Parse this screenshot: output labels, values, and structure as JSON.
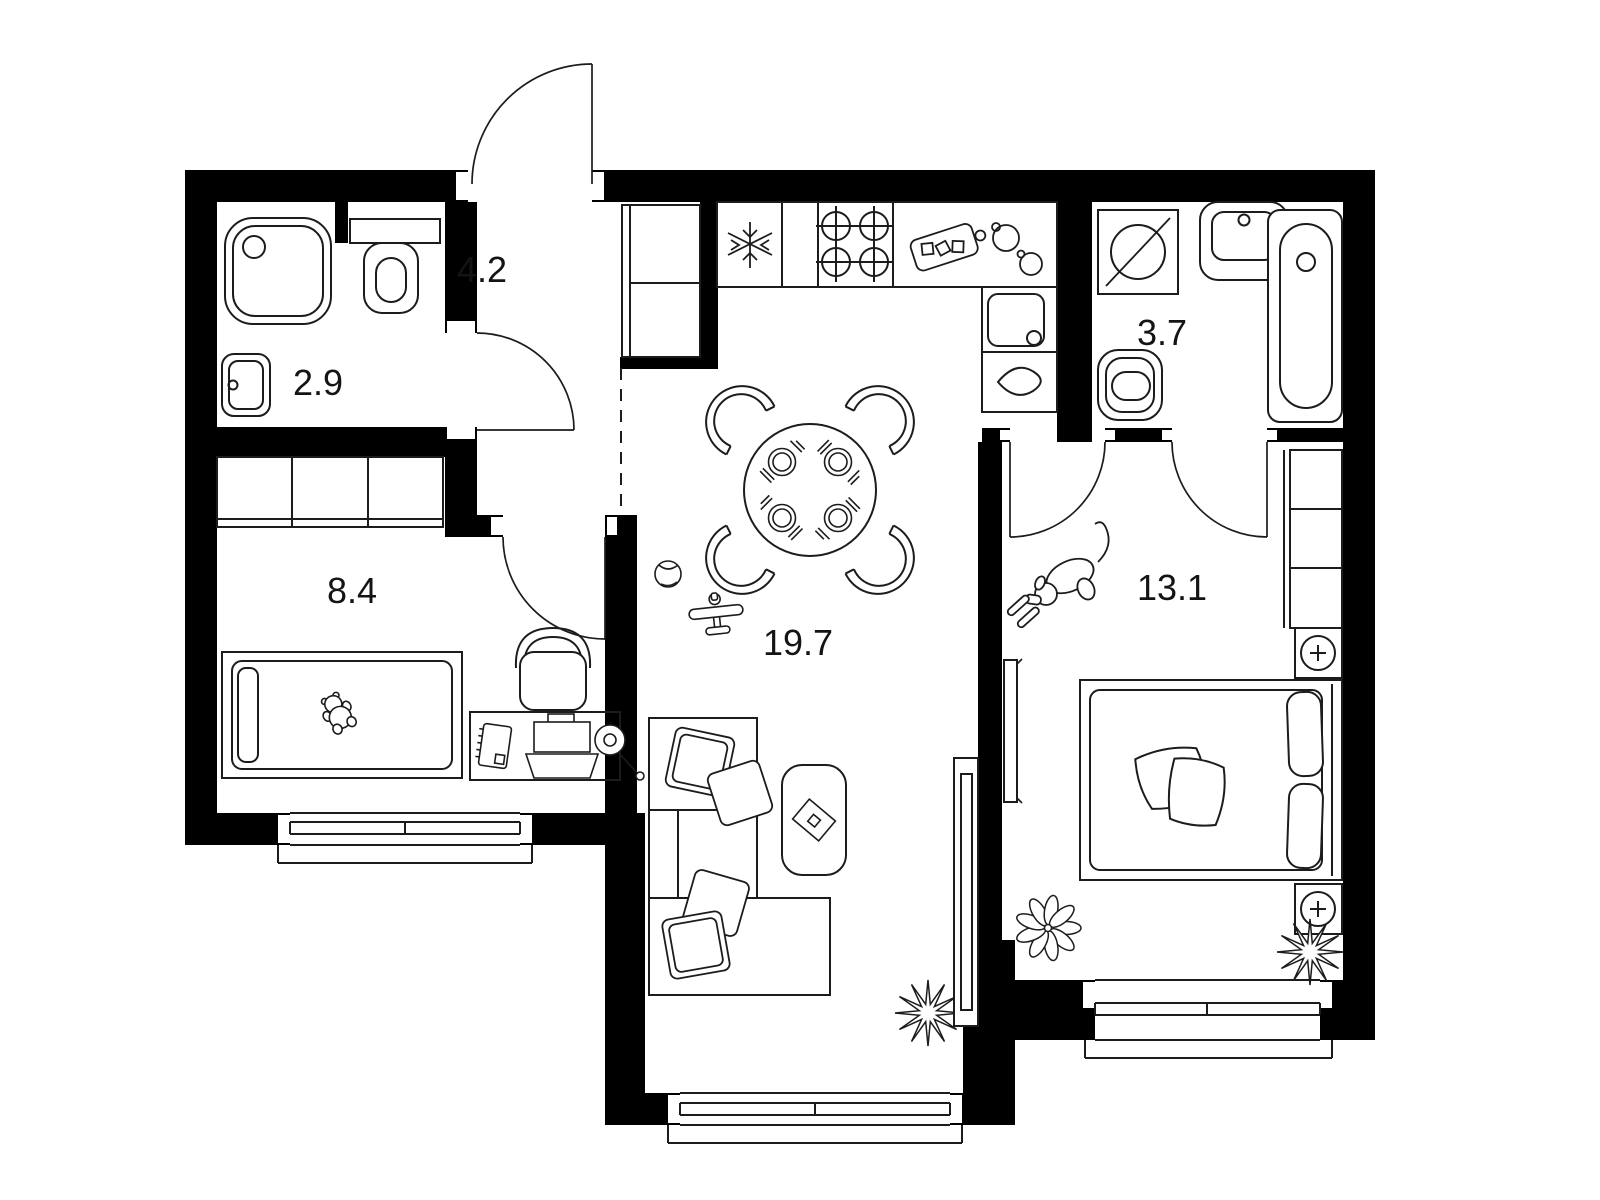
{
  "title": "Apartment floor plan",
  "colors": {
    "walls": "#000000",
    "lines": "#1c1c1c",
    "background": "#ffffff"
  },
  "units": "m2",
  "rooms": [
    {
      "id": "bathroom-small",
      "label": "2.9",
      "fixtures": [
        "shower-tray",
        "toilet",
        "cistern-shelf",
        "wash-basin"
      ]
    },
    {
      "id": "hallway",
      "label": "4.2",
      "fixtures": [
        "entry-door",
        "built-in-wardrobe"
      ]
    },
    {
      "id": "kids-room",
      "label": "8.4",
      "fixtures": [
        "wardrobe",
        "single-bed",
        "teddy-bear",
        "desk",
        "notebook",
        "laptop",
        "desk-lamp",
        "desk-chair",
        "window"
      ]
    },
    {
      "id": "living-kitchen",
      "label": "19.7",
      "fixtures": [
        "fridge",
        "hob-4-burners",
        "kitchen-counter",
        "cutting-board",
        "pots",
        "kitchen-sink",
        "dining-table",
        "dining-chairs-4",
        "place-settings-4",
        "toy-ball",
        "toy-plane",
        "corner-sofa",
        "sofa-pillows",
        "coffee-table",
        "book",
        "tv",
        "plant",
        "window"
      ]
    },
    {
      "id": "bathroom-large",
      "label": "3.7",
      "fixtures": [
        "washing-machine",
        "wash-basin",
        "bathtub",
        "toilet"
      ]
    },
    {
      "id": "bedroom",
      "label": "13.1",
      "fixtures": [
        "double-bed",
        "pillows",
        "blanket",
        "nightstand-top",
        "nightstand-bottom",
        "wardrobe",
        "tv",
        "dog",
        "leaf-plant",
        "star-plant",
        "window"
      ]
    }
  ]
}
